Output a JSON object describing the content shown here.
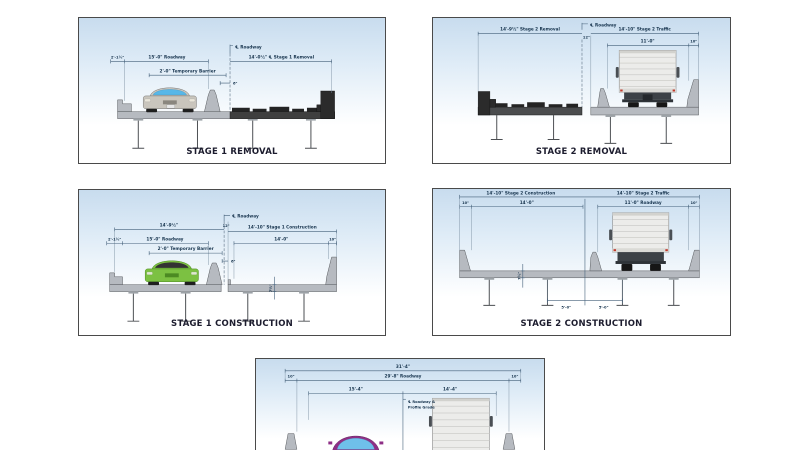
{
  "colors": {
    "panel_sky": "#c8dcee",
    "panel_border": "#4a4a4a",
    "dim_text": "#17344e",
    "title_text": "#1c1c2e",
    "concrete": "#b6bac0",
    "removal_dark": "#2b2b2b",
    "car_silver": "#c9c5bd",
    "car_green": "#7cc142",
    "car_purple": "#8e2f86",
    "truck_white": "#ececea",
    "glass_blue": "#57b7e8"
  },
  "panels": {
    "stage1_removal": {
      "title": "STAGE 1 REMOVAL",
      "labels": {
        "edge_dim": "2'-1½\"",
        "roadway_dim": "15'-0\" Roadway",
        "temp_barrier_dim": "2'-0\" Temporary Barrier",
        "centerline": "℄ Roadway",
        "offset_dim": "6\"",
        "removal_dim": "14'-0½\" ℄ Stage 1 Removal"
      }
    },
    "stage2_removal": {
      "title": "STAGE 2 REMOVAL",
      "labels": {
        "removal_dim": "14'-9½\" Stage 2 Removal",
        "centerline": "℄ Roadway",
        "joint_offset_dim": "12\"",
        "traffic_dim": "14'-10\" Stage 2 Traffic",
        "lane_dim": "11'-0\"",
        "parapet_dim": "10\""
      }
    },
    "stage1_construction": {
      "title": "STAGE 1 CONSTRUCTION",
      "labels": {
        "left_total_dim": "14'-9½\"",
        "centerline": "℄ Roadway",
        "joint_offset_dim": "12\"",
        "construction_dim": "14'-10\" Stage 1 Construction",
        "edge_dim": "2'-1½\"",
        "roadway_dim": "15'-0\" Roadway",
        "temp_barrier_dim": "2'-0\" Temporary Barrier",
        "gap_dim": "6\"",
        "deck_dim": "14'-0\"",
        "parapet_dim": "10\"",
        "thickness_dim": "7½\""
      }
    },
    "stage2_construction": {
      "title": "STAGE 2 CONSTRUCTION",
      "labels": {
        "construction_dim": "14'-10\" Stage 2 Construction",
        "traffic_dim": "14'-10\" Stage 2 Traffic",
        "parapet_left_dim": "10\"",
        "deck_dim": "14'-0\"",
        "roadway_dim": "11'-0\" Roadway",
        "parapet_right_dim": "10\"",
        "thickness_dim": "7½\"",
        "girder_spacing_left_dim": "5'-0\"",
        "girder_spacing_right_dim": "5'-0\""
      }
    },
    "final_section": {
      "labels": {
        "total_dim": "31'-4\"",
        "roadway_dim": "29'-8\" Roadway",
        "parapet_left_dim": "10\"",
        "parapet_right_dim": "10\"",
        "left_lane_dim": "15'-4\"",
        "right_lane_dim": "14'-4\"",
        "centerline_line1": "℄ Roadway &",
        "centerline_line2": "Profile Grade"
      }
    }
  }
}
